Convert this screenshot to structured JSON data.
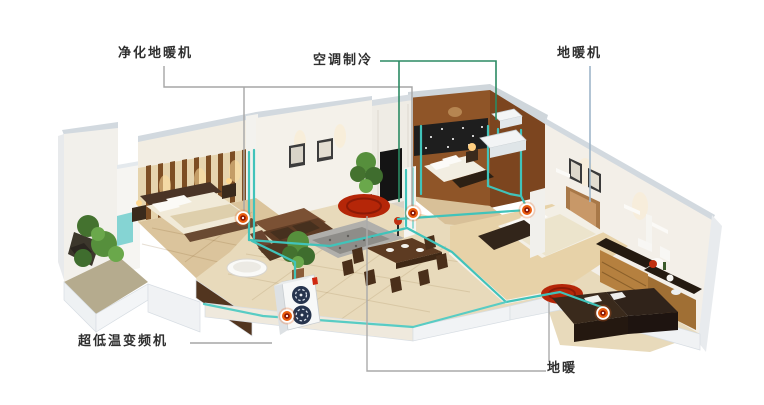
{
  "annotations": {
    "purify_floor_heating_unit": {
      "label": "净化地暖机"
    },
    "ac_cooling": {
      "label": "空调制冷"
    },
    "floor_heating_unit": {
      "label": "地暖机"
    },
    "ultra_low_temp_inverter_unit": {
      "label": "超低温变频机"
    },
    "floor_heating": {
      "label": "地暖"
    }
  },
  "colors": {
    "background": "#ffffff",
    "pipe_teal": "#41c3ba",
    "ac_leader_green": "#2b8a63",
    "leader_gray": "#a6a6a6",
    "floor_heating_leader_blue": "#9fb6c9",
    "hotspot_orange": "#ea5d0e",
    "heated_zone_red": "#b52608"
  },
  "icons": {
    "hotspot": "hotspot-marker",
    "fan_grille": "fan-grille-icon"
  }
}
